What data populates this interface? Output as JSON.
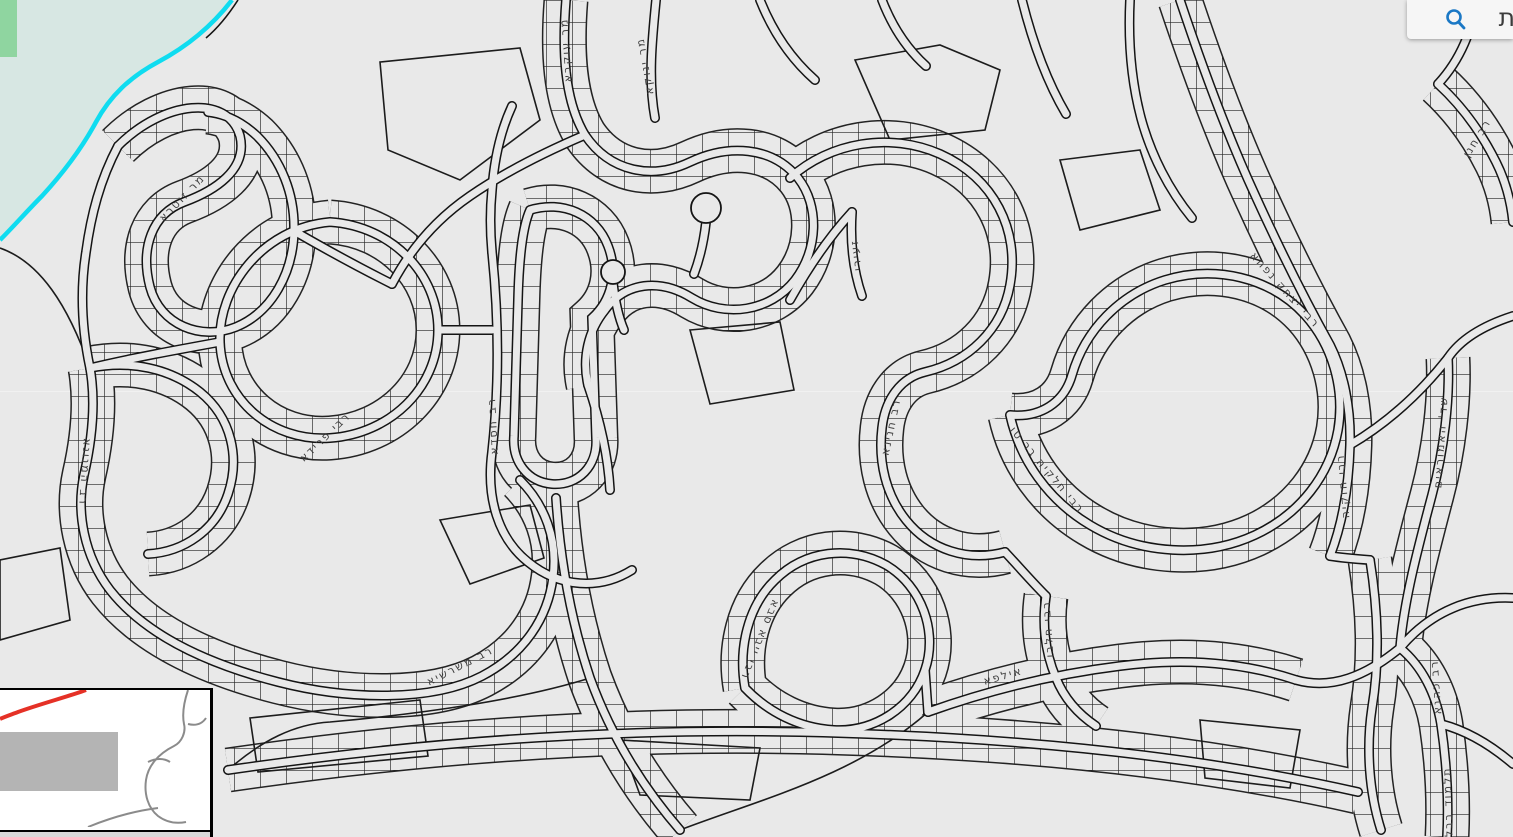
{
  "app": {
    "type": "interactive-gis-map-viewer"
  },
  "search_bar": {
    "query_visible_text": "ת",
    "icon": "search-icon",
    "icon_color": "#1b78c5",
    "background": "#f6f6f6"
  },
  "map": {
    "background_color": "#e9e9e9",
    "line_color": "#1c1c1c",
    "label_color": "#3f3f3f",
    "water_fill": "#d7e7e3",
    "shoreline_color": "#0fdcf0",
    "park_color": "#8fd5a0",
    "street_labels": [
      {
        "name": "מר עוקבא",
        "x": 566,
        "y": 50,
        "rot": -94
      },
      {
        "name": "מר ינוקא",
        "x": 645,
        "y": 66,
        "rot": -100
      },
      {
        "name": "מר זוטרא",
        "x": 182,
        "y": 198,
        "rot": -46
      },
      {
        "name": "רב המנונא",
        "x": 85,
        "y": 472,
        "rot": 94
      },
      {
        "name": "רבי פרידא",
        "x": 325,
        "y": 437,
        "rot": -44
      },
      {
        "name": "רב חסדא",
        "x": 493,
        "y": 426,
        "rot": -93
      },
      {
        "name": "רב משרשיא",
        "x": 460,
        "y": 666,
        "rot": -27
      },
      {
        "name": "רבי ייבא סבא",
        "x": 760,
        "y": 640,
        "rot": 112
      },
      {
        "name": "זעירי",
        "x": 856,
        "y": 255,
        "rot": -97
      },
      {
        "name": "רב חנינא",
        "x": 891,
        "y": 427,
        "rot": -78
      },
      {
        "name": "רבי חלקיה בר טו",
        "x": 1047,
        "y": 470,
        "rot": 50
      },
      {
        "name": "רבי יצחק נפחא",
        "x": 1285,
        "y": 290,
        "rot": 48
      },
      {
        "name": "רבי חזקיה",
        "x": 1343,
        "y": 486,
        "rot": -95
      },
      {
        "name": "שד' האמוראים",
        "x": 1441,
        "y": 442,
        "rot": -86
      },
      {
        "name": "רבי חלבו",
        "x": 1048,
        "y": 629,
        "rot": -94
      },
      {
        "name": "אילפא",
        "x": 1003,
        "y": 676,
        "rot": -16
      },
      {
        "name": "רב חנן",
        "x": 1477,
        "y": 138,
        "rot": -58
      },
      {
        "name": "רב כהנא",
        "x": 1436,
        "y": 687,
        "rot": -94
      },
      {
        "name": "תלמוד בבלי",
        "x": 1448,
        "y": 804,
        "rot": -92
      }
    ]
  },
  "inset_map": {
    "background": "#ffffff",
    "border_color": "#000000",
    "extent_line_color": "#e53126",
    "built_area_color": "#b4b4b4",
    "coastline_color": "#8b8b8b"
  }
}
